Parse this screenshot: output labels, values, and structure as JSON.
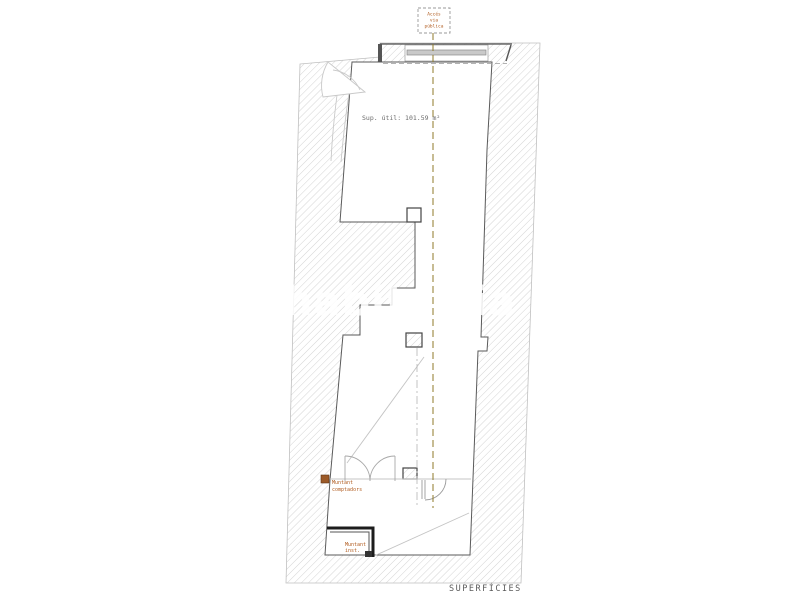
{
  "document": {
    "type": "architectural-floor-plan",
    "sheet_title": "SUPERFÍCIES",
    "watermark": "habitaclia"
  },
  "plan": {
    "access_box": {
      "line1": "Accés",
      "line2": "via",
      "line3": "pública"
    },
    "area_label": "Sup. útil: 101.59 m²",
    "meter_label": {
      "line1": "Muntant",
      "line2": "comptadors"
    },
    "utility_label": {
      "line1": "Muntant",
      "line2": "inst."
    }
  },
  "colors": {
    "background": "#ffffff",
    "hatch_line": "#cfcfcf",
    "plan_outline": "#5a5a5a",
    "light_line": "#c4c4c4",
    "centerline_olive": "#8f7a2a",
    "accent_text": "#b05a1d",
    "muted_text": "#6b6b6b",
    "dark_wall": "#1c1c1c",
    "meter_icon": "#9c5a28",
    "watermark": "#ffffff"
  }
}
